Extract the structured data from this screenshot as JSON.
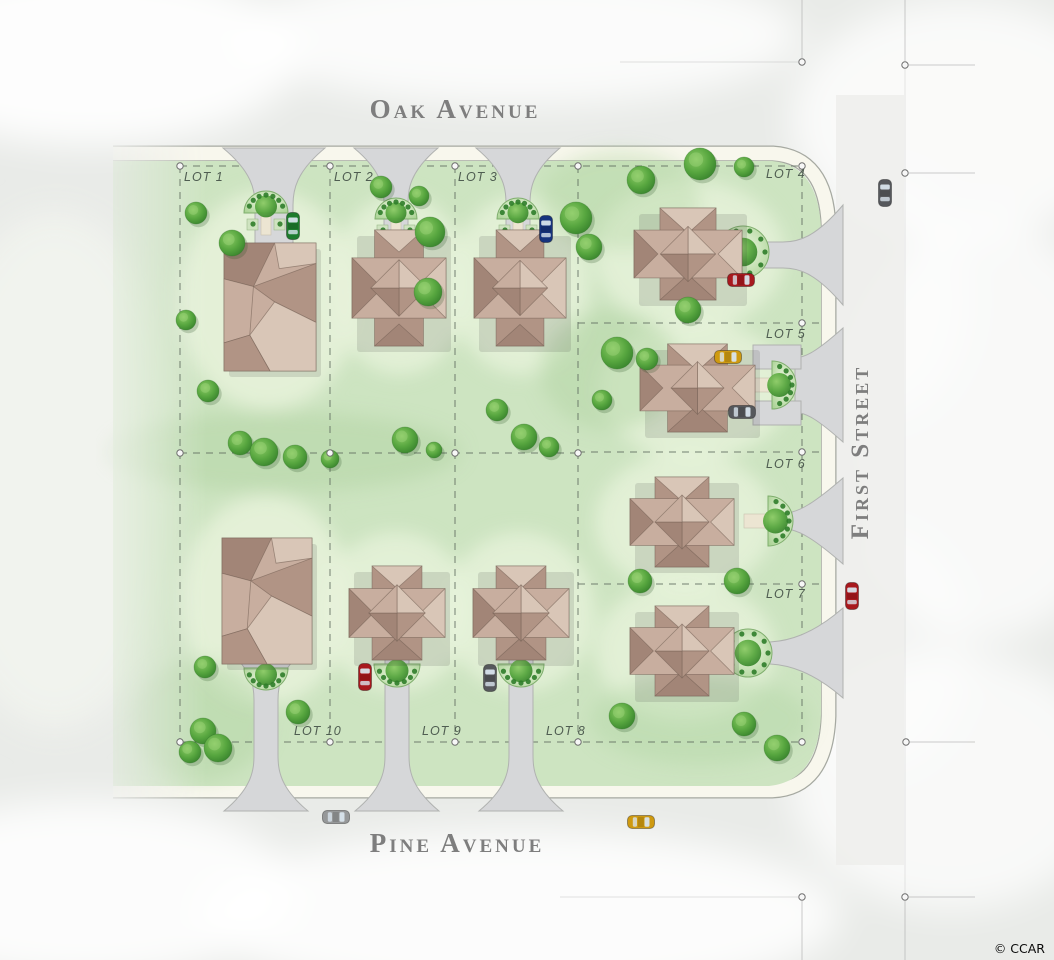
{
  "labels": {
    "oak_avenue": "Oak Avenue",
    "pine_avenue": "Pine Avenue",
    "first_street": "First Street",
    "credit": "© CCAR"
  },
  "lots": [
    {
      "label": "LOT 1",
      "x": 184,
      "y": 181
    },
    {
      "label": "LOT 2",
      "x": 334,
      "y": 181
    },
    {
      "label": "LOT 3",
      "x": 458,
      "y": 181
    },
    {
      "label": "LOT 4",
      "x": 766,
      "y": 178
    },
    {
      "label": "LOT 5",
      "x": 766,
      "y": 338
    },
    {
      "label": "LOT 6",
      "x": 766,
      "y": 468
    },
    {
      "label": "LOT 7",
      "x": 766,
      "y": 598
    },
    {
      "label": "LOT 8",
      "x": 546,
      "y": 735
    },
    {
      "label": "LOT 9",
      "x": 422,
      "y": 735
    },
    {
      "label": "LOT 10",
      "x": 294,
      "y": 735
    }
  ],
  "colors": {
    "bg": "#e9ebe8",
    "fog": "#ffffff",
    "plotGreen": "#cde4c1",
    "plotLight": "#e7f2db",
    "plotDark": "#b4d6a6",
    "curbBand": "#f8f7ed",
    "curbLine": "#a6a9a1",
    "road": "#eeeeec",
    "rowLine": "#ababab",
    "drive": "#d6d7d9",
    "driveEdge": "#b0b2b0",
    "walk": "#ece5d2",
    "walkEdge": "#c9c2ae",
    "houseBody": "#cdb6a8",
    "roofA": "#c8ae9f",
    "roofB": "#b19485",
    "roofC": "#a28577",
    "roofD": "#d9c6b7",
    "roofEdge": "#74605531",
    "roofStroke": "#74605599",
    "treeDark": "#3f8c33",
    "treeLight": "#7fbf5e",
    "treeHi": "#9ed47a",
    "shrub": "#2f7d2a",
    "gardenFill": "#dff0d2",
    "gardenRim": "#7fae6d",
    "lotLine": "#5f6b5f",
    "pinFill": "#f7f7f7",
    "pinStroke": "#6f6f6f",
    "label": "#4f5d51",
    "street": "#7e7e7e",
    "carRed": "#a8191e",
    "carYellow": "#cf9a10",
    "carGreen": "#1e7c2d",
    "carBlue": "#16337d",
    "carGray": "#969899",
    "carDark": "#56585c",
    "glass": "#d8e4ec"
  },
  "boundaries": [
    {
      "x1": 180,
      "y1": 166,
      "x2": 802,
      "y2": 166
    },
    {
      "x1": 180,
      "y1": 166,
      "x2": 180,
      "y2": 742
    },
    {
      "x1": 330,
      "y1": 166,
      "x2": 330,
      "y2": 742
    },
    {
      "x1": 455,
      "y1": 166,
      "x2": 455,
      "y2": 742
    },
    {
      "x1": 578,
      "y1": 166,
      "x2": 578,
      "y2": 742
    },
    {
      "x1": 802,
      "y1": 166,
      "x2": 802,
      "y2": 742
    },
    {
      "x1": 180,
      "y1": 453,
      "x2": 578,
      "y2": 453
    },
    {
      "x1": 578,
      "y1": 323,
      "x2": 819,
      "y2": 323
    },
    {
      "x1": 578,
      "y1": 452,
      "x2": 819,
      "y2": 452
    },
    {
      "x1": 578,
      "y1": 584,
      "x2": 819,
      "y2": 584
    },
    {
      "x1": 180,
      "y1": 742,
      "x2": 802,
      "y2": 742
    }
  ],
  "pins": [
    {
      "x": 180,
      "y": 166
    },
    {
      "x": 330,
      "y": 166
    },
    {
      "x": 455,
      "y": 166
    },
    {
      "x": 578,
      "y": 166
    },
    {
      "x": 802,
      "y": 166
    },
    {
      "x": 180,
      "y": 453
    },
    {
      "x": 330,
      "y": 453
    },
    {
      "x": 455,
      "y": 453
    },
    {
      "x": 578,
      "y": 453
    },
    {
      "x": 802,
      "y": 323
    },
    {
      "x": 802,
      "y": 452
    },
    {
      "x": 802,
      "y": 584
    },
    {
      "x": 180,
      "y": 742
    },
    {
      "x": 330,
      "y": 742
    },
    {
      "x": 455,
      "y": 742
    },
    {
      "x": 578,
      "y": 742
    },
    {
      "x": 802,
      "y": 742
    },
    {
      "x": 802,
      "y": 62
    },
    {
      "x": 905,
      "y": 65
    },
    {
      "x": 905,
      "y": 173
    },
    {
      "x": 906,
      "y": 742
    },
    {
      "x": 802,
      "y": 897
    },
    {
      "x": 905,
      "y": 897
    }
  ],
  "survey_marks": [
    {
      "x1": 802,
      "y1": 0,
      "x2": 802,
      "y2": 58,
      "o": 0.6
    },
    {
      "x1": 905,
      "y1": 0,
      "x2": 905,
      "y2": 61,
      "o": 0.6
    },
    {
      "x1": 909,
      "y1": 65,
      "x2": 975,
      "y2": 65,
      "o": 0.6
    },
    {
      "x1": 909,
      "y1": 173,
      "x2": 975,
      "y2": 173,
      "o": 0.6
    },
    {
      "x1": 909,
      "y1": 742,
      "x2": 975,
      "y2": 742,
      "o": 0.6
    },
    {
      "x1": 909,
      "y1": 897,
      "x2": 975,
      "y2": 897,
      "o": 0.6
    },
    {
      "x1": 802,
      "y1": 901,
      "x2": 802,
      "y2": 960,
      "o": 0.6
    },
    {
      "x1": 905,
      "y1": 901,
      "x2": 905,
      "y2": 960,
      "o": 0.6
    },
    {
      "x1": 620,
      "y1": 62,
      "x2": 798,
      "y2": 62,
      "o": 0.35
    },
    {
      "x1": 560,
      "y1": 897,
      "x2": 798,
      "y2": 897,
      "o": 0.35
    },
    {
      "x1": 905,
      "y1": 65,
      "x2": 905,
      "y2": 897,
      "o": 0.28
    }
  ],
  "houses": [
    {
      "lot": 1,
      "type": "B",
      "x": 224,
      "y": 243,
      "w": 92,
      "h": 128
    },
    {
      "lot": 2,
      "type": "A",
      "x": 352,
      "y": 230,
      "w": 94,
      "h": 116
    },
    {
      "lot": 3,
      "type": "A",
      "x": 474,
      "y": 230,
      "w": 92,
      "h": 116
    },
    {
      "lot": 4,
      "type": "A",
      "x": 634,
      "y": 208,
      "w": 108,
      "h": 92
    },
    {
      "lot": 5,
      "type": "A",
      "x": 640,
      "y": 344,
      "w": 115,
      "h": 88
    },
    {
      "lot": 6,
      "type": "A",
      "x": 630,
      "y": 477,
      "w": 104,
      "h": 90
    },
    {
      "lot": 7,
      "type": "A",
      "x": 630,
      "y": 606,
      "w": 104,
      "h": 90
    },
    {
      "lot": 8,
      "type": "A",
      "x": 473,
      "y": 566,
      "w": 96,
      "h": 94
    },
    {
      "lot": 9,
      "type": "A",
      "x": 349,
      "y": 566,
      "w": 96,
      "h": 94
    },
    {
      "lot": 10,
      "type": "B",
      "x": 222,
      "y": 538,
      "w": 90,
      "h": 126
    }
  ],
  "gardens": [
    {
      "x": 266,
      "y": 213,
      "r": 22,
      "dir": "up"
    },
    {
      "x": 396,
      "y": 219,
      "r": 21,
      "dir": "up"
    },
    {
      "x": 518,
      "y": 219,
      "r": 21,
      "dir": "up"
    },
    {
      "x": 743,
      "y": 252,
      "r": 26,
      "dir": "circle"
    },
    {
      "x": 772,
      "y": 385,
      "r": 24,
      "dir": "right"
    },
    {
      "x": 768,
      "y": 521,
      "r": 25,
      "dir": "right"
    },
    {
      "x": 748,
      "y": 653,
      "r": 24,
      "dir": "circle"
    },
    {
      "x": 521,
      "y": 664,
      "r": 23,
      "dir": "down"
    },
    {
      "x": 397,
      "y": 664,
      "r": 23,
      "dir": "down"
    },
    {
      "x": 266,
      "y": 668,
      "r": 22,
      "dir": "down"
    }
  ],
  "trees": [
    {
      "x": 196,
      "y": 213,
      "r": 11
    },
    {
      "x": 232,
      "y": 243,
      "r": 13
    },
    {
      "x": 381,
      "y": 187,
      "r": 11
    },
    {
      "x": 419,
      "y": 196,
      "r": 10
    },
    {
      "x": 430,
      "y": 232,
      "r": 15
    },
    {
      "x": 428,
      "y": 292,
      "r": 14
    },
    {
      "x": 576,
      "y": 218,
      "r": 16
    },
    {
      "x": 589,
      "y": 247,
      "r": 13
    },
    {
      "x": 641,
      "y": 180,
      "r": 14
    },
    {
      "x": 700,
      "y": 164,
      "r": 16
    },
    {
      "x": 744,
      "y": 167,
      "r": 10
    },
    {
      "x": 186,
      "y": 320,
      "r": 10
    },
    {
      "x": 208,
      "y": 391,
      "r": 11
    },
    {
      "x": 240,
      "y": 443,
      "r": 12
    },
    {
      "x": 264,
      "y": 452,
      "r": 14
    },
    {
      "x": 295,
      "y": 457,
      "r": 12
    },
    {
      "x": 330,
      "y": 459,
      "r": 9
    },
    {
      "x": 405,
      "y": 440,
      "r": 13
    },
    {
      "x": 434,
      "y": 450,
      "r": 8
    },
    {
      "x": 497,
      "y": 410,
      "r": 11
    },
    {
      "x": 524,
      "y": 437,
      "r": 13
    },
    {
      "x": 549,
      "y": 447,
      "r": 10
    },
    {
      "x": 617,
      "y": 353,
      "r": 16
    },
    {
      "x": 647,
      "y": 359,
      "r": 11
    },
    {
      "x": 688,
      "y": 310,
      "r": 13
    },
    {
      "x": 602,
      "y": 400,
      "r": 10
    },
    {
      "x": 640,
      "y": 581,
      "r": 12
    },
    {
      "x": 737,
      "y": 581,
      "r": 13
    },
    {
      "x": 205,
      "y": 667,
      "r": 11
    },
    {
      "x": 203,
      "y": 731,
      "r": 13
    },
    {
      "x": 218,
      "y": 748,
      "r": 14
    },
    {
      "x": 190,
      "y": 752,
      "r": 11
    },
    {
      "x": 298,
      "y": 712,
      "r": 12
    },
    {
      "x": 622,
      "y": 716,
      "r": 13
    },
    {
      "x": 744,
      "y": 724,
      "r": 12
    },
    {
      "x": 777,
      "y": 748,
      "r": 13
    }
  ],
  "cars": [
    {
      "x": 293,
      "y": 226,
      "o": "v",
      "c": "carGreen"
    },
    {
      "x": 546,
      "y": 229,
      "o": "v",
      "c": "carBlue"
    },
    {
      "x": 741,
      "y": 280,
      "o": "h",
      "c": "carRed"
    },
    {
      "x": 728,
      "y": 357,
      "o": "h",
      "c": "carYellow"
    },
    {
      "x": 742,
      "y": 412,
      "o": "h",
      "c": "carDark"
    },
    {
      "x": 852,
      "y": 596,
      "o": "v",
      "c": "carRed"
    },
    {
      "x": 885,
      "y": 193,
      "o": "v",
      "c": "carDark"
    },
    {
      "x": 365,
      "y": 677,
      "o": "v",
      "c": "carRed"
    },
    {
      "x": 490,
      "y": 678,
      "o": "v",
      "c": "carDark"
    },
    {
      "x": 336,
      "y": 817,
      "o": "h",
      "c": "carGray"
    },
    {
      "x": 641,
      "y": 822,
      "o": "h",
      "c": "carYellow"
    }
  ]
}
